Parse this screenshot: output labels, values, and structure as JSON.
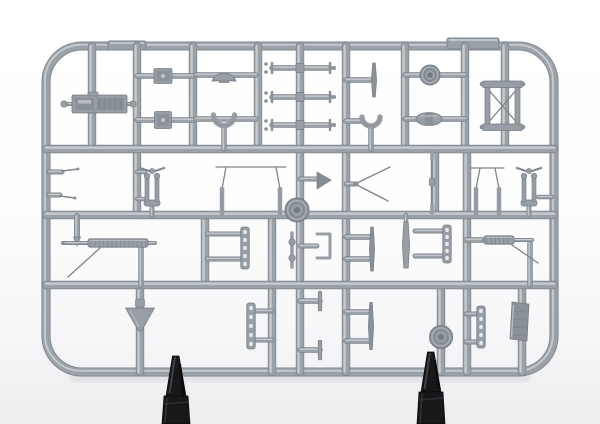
{
  "meta": {
    "alt": "Photograph of a grey injection-moulded plastic model kit sprue (parts tree) with many small aircraft detail parts, held upright by two dark clips at the bottom, on a white studio background"
  },
  "scene": {
    "palette": {
      "rail": "#9aa1a8",
      "rail_highlight": "#cdd1d5",
      "rail_shadow": "#7b828a",
      "part": "#989ea6",
      "part_mid": "#8a9199",
      "part_dark": "#747b83",
      "part_light": "#c4c8cc",
      "hole": "#e9eaec",
      "wire": "#7f868e",
      "flag_fill": "#848b93",
      "shadow": "#c9cbce",
      "clip_dark": "#17181a",
      "clip_mid": "#2e2f32",
      "clip_light": "#4a4c4f",
      "clip_deep": "#050506"
    },
    "frame": {
      "x": 46,
      "y": 46,
      "w": 508,
      "h": 326,
      "radius": 36,
      "thickness": 7.5
    },
    "tabs": [
      {
        "x": 108,
        "y": 41,
        "w": 38,
        "h": 9
      },
      {
        "x": 447,
        "y": 38,
        "w": 52,
        "h": 11
      }
    ],
    "h_rails": [
      {
        "y": 149,
        "x1": 46,
        "x2": 554
      },
      {
        "y": 215,
        "x1": 46,
        "x2": 554
      },
      {
        "y": 285,
        "x1": 46,
        "x2": 554
      }
    ],
    "v_rails": [
      {
        "x": 92,
        "y1": 46,
        "y2": 149
      },
      {
        "x": 137,
        "y1": 46,
        "y2": 215
      },
      {
        "x": 193,
        "y1": 46,
        "y2": 149
      },
      {
        "x": 258,
        "y1": 46,
        "y2": 149
      },
      {
        "x": 300,
        "y1": 46,
        "y2": 372
      },
      {
        "x": 346,
        "y1": 46,
        "y2": 372
      },
      {
        "x": 405,
        "y1": 46,
        "y2": 149
      },
      {
        "x": 465,
        "y1": 46,
        "y2": 149
      },
      {
        "x": 505,
        "y1": 46,
        "y2": 149
      },
      {
        "x": 435,
        "y1": 149,
        "y2": 215
      },
      {
        "x": 467,
        "y1": 149,
        "y2": 372
      },
      {
        "x": 205,
        "y1": 215,
        "y2": 285
      },
      {
        "x": 272,
        "y1": 215,
        "y2": 372
      },
      {
        "x": 140,
        "y1": 285,
        "y2": 372
      },
      {
        "x": 441,
        "y1": 285,
        "y2": 372
      },
      {
        "x": 522,
        "y1": 285,
        "y2": 372
      }
    ],
    "gates": [
      [
        137,
        76,
        193,
        76,
        4
      ],
      [
        137,
        120,
        193,
        120,
        4
      ],
      [
        196,
        75,
        256,
        75,
        4
      ],
      [
        196,
        119,
        256,
        119,
        4
      ],
      [
        224,
        126,
        224,
        149,
        4
      ],
      [
        346,
        80,
        371,
        80,
        4
      ],
      [
        346,
        121,
        363,
        121,
        4
      ],
      [
        371,
        128,
        371,
        149,
        4
      ],
      [
        405,
        75,
        465,
        75,
        4
      ],
      [
        405,
        119,
        465,
        119,
        4
      ],
      [
        64,
        104,
        74,
        104,
        2.5
      ],
      [
        125,
        104,
        133,
        104,
        2.5
      ],
      [
        49,
        172,
        62,
        172,
        3.5
      ],
      [
        49,
        195,
        60,
        195,
        3.5
      ],
      [
        137,
        172,
        145,
        172,
        3
      ],
      [
        137,
        199,
        145,
        199,
        3
      ],
      [
        152,
        205,
        152,
        215,
        3.5
      ],
      [
        300,
        179,
        317,
        179,
        3.5
      ],
      [
        346,
        184,
        356,
        184,
        3.5
      ],
      [
        529,
        205,
        529,
        215,
        3.5
      ],
      [
        538,
        197,
        552,
        197,
        3
      ],
      [
        141,
        245,
        141,
        285,
        4
      ],
      [
        207,
        234,
        242,
        234,
        3.5
      ],
      [
        207,
        259,
        242,
        259,
        3.5
      ],
      [
        300,
        246,
        317,
        246,
        3.5
      ],
      [
        346,
        237,
        371,
        237,
        4
      ],
      [
        346,
        259,
        371,
        259,
        4
      ],
      [
        406,
        215,
        406,
        224,
        3
      ],
      [
        415,
        231,
        444,
        231,
        3.5
      ],
      [
        415,
        256,
        444,
        256,
        3.5
      ],
      [
        466,
        240,
        485,
        240,
        4
      ],
      [
        530,
        243,
        530,
        285,
        4
      ],
      [
        255,
        311,
        272,
        311,
        3.5
      ],
      [
        255,
        340,
        272,
        340,
        3.5
      ],
      [
        300,
        301,
        320,
        301,
        4
      ],
      [
        300,
        350,
        320,
        350,
        4
      ],
      [
        346,
        312,
        370,
        312,
        4
      ],
      [
        346,
        341,
        370,
        341,
        4
      ],
      [
        466,
        314,
        478,
        314,
        3.5
      ],
      [
        466,
        342,
        478,
        342,
        3.5
      ]
    ],
    "wires": [
      [
        62,
        171,
        78,
        169
      ],
      [
        60,
        196,
        75,
        198
      ]
    ],
    "parts": [
      {
        "type": "engine",
        "x": 98,
        "y": 104
      },
      {
        "type": "square",
        "x": 163,
        "y": 76,
        "w": 18,
        "h": 15
      },
      {
        "type": "square",
        "x": 163,
        "y": 120,
        "w": 17,
        "h": 17
      },
      {
        "type": "fan",
        "x": 224,
        "y": 75
      },
      {
        "type": "cup",
        "x": 224,
        "y": 119,
        "r": 10.5
      },
      {
        "type": "cup",
        "x": 371,
        "y": 121,
        "r": 9
      },
      {
        "type": "axle",
        "x": 300,
        "y": 68
      },
      {
        "type": "axle",
        "x": 300,
        "y": 97
      },
      {
        "type": "axle",
        "x": 300,
        "y": 125
      },
      {
        "type": "blade",
        "x": 374,
        "y": 80,
        "h": 34
      },
      {
        "type": "wheel",
        "x": 430,
        "y": 75,
        "r": 10
      },
      {
        "type": "barrel",
        "x": 429,
        "y": 119
      },
      {
        "type": "xframe",
        "x": 502,
        "y": 106
      },
      {
        "type": "hat",
        "x": 152,
        "y": 171
      },
      {
        "type": "fork",
        "x": 152,
        "y": 190
      },
      {
        "type": "pins",
        "x1": 222,
        "x2": 280,
        "base": 214,
        "barx1": 216,
        "barx2": 286,
        "bary": 167
      },
      {
        "type": "flag",
        "x": 317,
        "y": 180
      },
      {
        "type": "vwire",
        "x": 355,
        "y": 184
      },
      {
        "type": "thinrod",
        "x": 432,
        "y1": 151,
        "y2": 213
      },
      {
        "type": "pins",
        "x1": 476,
        "x2": 499,
        "base": 214,
        "barx1": 471,
        "barx2": 504,
        "bary": 168
      },
      {
        "type": "hat",
        "x": 529,
        "y": 171
      },
      {
        "type": "fork",
        "x": 529,
        "y": 190
      },
      {
        "type": "wheel",
        "x": 297,
        "y": 210,
        "r": 12
      },
      {
        "type": "arrowrod",
        "x": 77,
        "y1": 216,
        "y2": 246
      },
      {
        "type": "mgun",
        "x1": 63,
        "x2": 155,
        "y": 243,
        "rib1": 88,
        "rib2": 148,
        "wire": [
          100,
          248,
          68,
          277
        ]
      },
      {
        "type": "ladder",
        "x": 245,
        "y": 248,
        "h": 42
      },
      {
        "type": "bulge",
        "x": 292,
        "y": 250
      },
      {
        "type": "cbr",
        "x": 317,
        "y": 246
      },
      {
        "type": "blade",
        "x": 372,
        "y": 249,
        "h": 44
      },
      {
        "type": "strut",
        "x": 406,
        "y": 245,
        "h": 46
      },
      {
        "type": "ladder",
        "x": 447,
        "y": 244,
        "h": 38
      },
      {
        "type": "mgun",
        "x1": 484,
        "x2": 532,
        "y": 240,
        "rib1": 484,
        "rib2": 514,
        "wire": [
          512,
          245,
          538,
          263
        ]
      },
      {
        "type": "funnel",
        "x": 140,
        "y": 308
      },
      {
        "type": "ladder",
        "x": 251,
        "y": 326,
        "h": 46
      },
      {
        "type": "ttab",
        "x": 320,
        "y": 301
      },
      {
        "type": "ttab",
        "x": 320,
        "y": 350
      },
      {
        "type": "blade",
        "x": 371,
        "y": 326,
        "h": 47
      },
      {
        "type": "wheel",
        "x": 441,
        "y": 337,
        "r": 11.5
      },
      {
        "type": "ladder",
        "x": 481,
        "y": 327,
        "h": 42
      },
      {
        "type": "radiator",
        "x": 521,
        "y": 321
      }
    ],
    "clips": {
      "left": {
        "cx": 176,
        "tip_y": 356
      },
      "right": {
        "cx": 431,
        "tip_y": 352
      }
    },
    "shadow": {
      "x": 70,
      "y": 374,
      "w": 460,
      "h": 8
    }
  }
}
